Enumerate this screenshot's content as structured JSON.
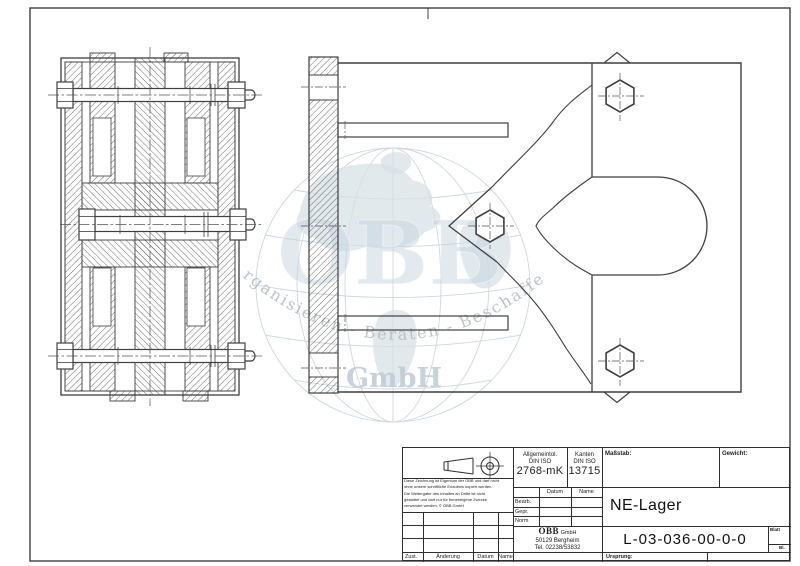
{
  "watermark": {
    "brand": "OBB",
    "tagline": "Organisieren - Beraten - Beschaffen",
    "suffix": "GmbH"
  },
  "title_block": {
    "tolerance": {
      "line1": "Allgemeintol.",
      "line2": "DIN ISO",
      "value": "2768-mK"
    },
    "kanten": {
      "line1": "Kanten",
      "line2": "DIN ISO",
      "value": "13715"
    },
    "masstab_label": "Maßstab:",
    "gewicht_label": "Gewicht:",
    "part_name": "NE-Lager",
    "drawing_number": "L-03-036-00-0-0",
    "blatt_label": "Blatt",
    "bl_label": "Bl.",
    "ursprung_label": "Ursprung:",
    "approval": {
      "datum_header": "Datum",
      "name_header": "Name",
      "rows": [
        "Bearb.",
        "Gepr.",
        "Norm"
      ]
    },
    "company": {
      "name": "OBB",
      "form": "GmbH",
      "address": "50129 Bergheim",
      "phone": "Tel. 02238/53832"
    },
    "revision": {
      "zust": "Zust.",
      "aenderung": "Änderung",
      "datum": "Datum",
      "name": "Name"
    },
    "disclaimer": [
      "Diese Zeichnung ist Eigentum der OBB und darf nicht",
      "ohne unsere schriftliche Erlaubnis kopiert werden.",
      "Die Weitergabe des Inhaltes an Dritte ist nicht",
      "gestattet und darf nur für firmeneigene Zwecke",
      "verwendet werden. © OBB GmbH"
    ]
  },
  "colors": {
    "line": "#3f3f3f",
    "block_line": "#2f2f2f",
    "watermark_blue": "#b9c9d8",
    "watermark_grid": "#b6c5d2",
    "watermark_land": "#cdd9e2",
    "watermark_text": "#9da8b3",
    "background": "#ffffff"
  }
}
